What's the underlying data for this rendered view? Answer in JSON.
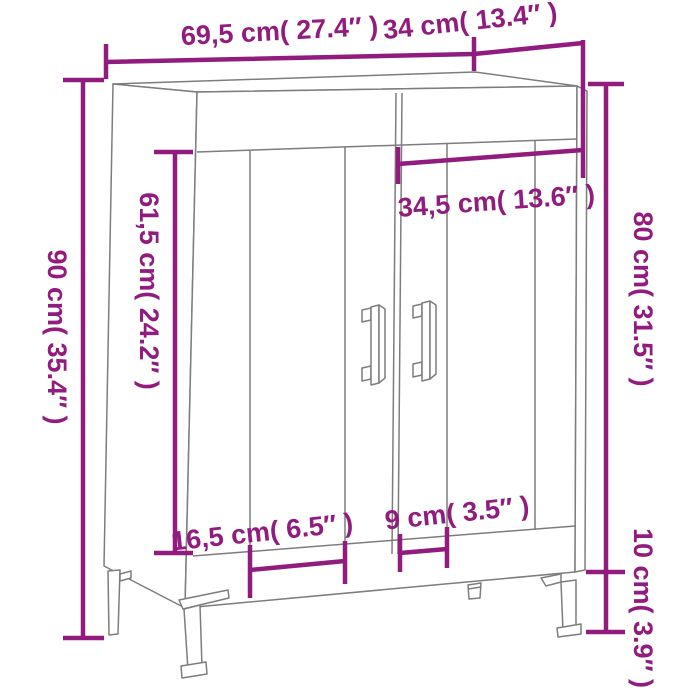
{
  "diagram": {
    "colors": {
      "dimension": "#911c7e",
      "outline": "#7d7d7d",
      "background": "#ffffff"
    },
    "dimensions": {
      "width": {
        "label": "69,5 cm( 27.4″ )",
        "cm": 69.5,
        "inches": 27.4
      },
      "depth": {
        "label": "34 cm( 13.4″ )",
        "cm": 34,
        "inches": 13.4
      },
      "height": {
        "label": "90 cm( 35.4″ )",
        "cm": 90,
        "inches": 35.4
      },
      "door_height": {
        "label": "61,5 cm( 24.2″ )",
        "cm": 61.5,
        "inches": 24.2
      },
      "door_width": {
        "label": "34,5 cm( 13.6″ )",
        "cm": 34.5,
        "inches": 13.6
      },
      "body_height": {
        "label": "80 cm( 31.5″ )",
        "cm": 80,
        "inches": 31.5
      },
      "leg_height": {
        "label": "10 cm( 3.9″ )",
        "cm": 10,
        "inches": 3.9
      },
      "left_leg_inset": {
        "label": "16,5 cm( 6.5″ )",
        "cm": 16.5,
        "inches": 6.5
      },
      "right_leg_inset": {
        "label": "9 cm( 3.5″ )",
        "cm": 9,
        "inches": 3.5
      }
    }
  }
}
